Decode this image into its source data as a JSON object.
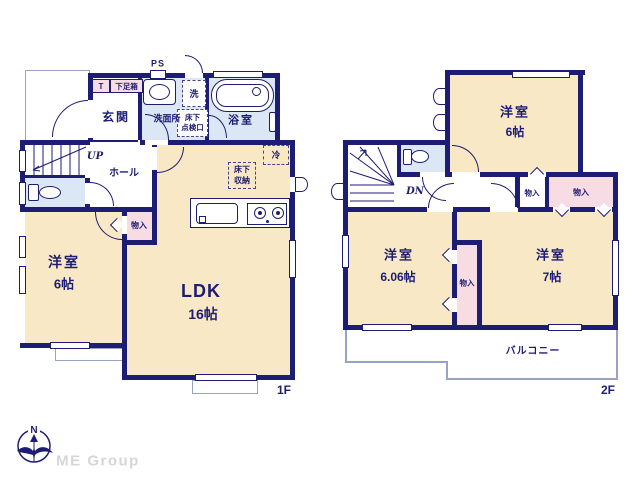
{
  "floor1": {
    "floor_label": "1F",
    "labels": {
      "ps": "PS",
      "t": "T",
      "shoe_box": "下足箱",
      "entrance": "玄関",
      "washroom": "洗面所",
      "laundry": "洗",
      "inspection_line1": "床下",
      "inspection_line2": "点検口",
      "bathroom": "浴室",
      "up": "UP",
      "hall": "ホール",
      "closet": "物入",
      "bedroom": "洋室",
      "bedroom_size": "6帖",
      "ldk": "LDK",
      "ldk_size": "16帖",
      "refrigerator": "冷",
      "floor_storage_line1": "床下",
      "floor_storage_line2": "収納"
    }
  },
  "floor2": {
    "floor_label": "2F",
    "labels": {
      "down": "DN",
      "bedroom_a": "洋室",
      "bedroom_a_size": "6帖",
      "closet_a": "物入",
      "closet_b": "物入",
      "closet_c": "物入",
      "bedroom_b": "洋室",
      "bedroom_b_size": "6.06帖",
      "bedroom_c": "洋室",
      "bedroom_c_size": "7帖",
      "balcony": "バルコニー"
    }
  },
  "footer": {
    "brand": "ME Group",
    "compass_north": "N"
  },
  "colors": {
    "wall": "#1d1d73",
    "room_cream": "#f8e8c5",
    "wet_blue": "#dbe7f4",
    "closet_pink": "#f8dce3",
    "outline_gray": "#98a2c4",
    "brand_gray": "#d6d6d6"
  }
}
